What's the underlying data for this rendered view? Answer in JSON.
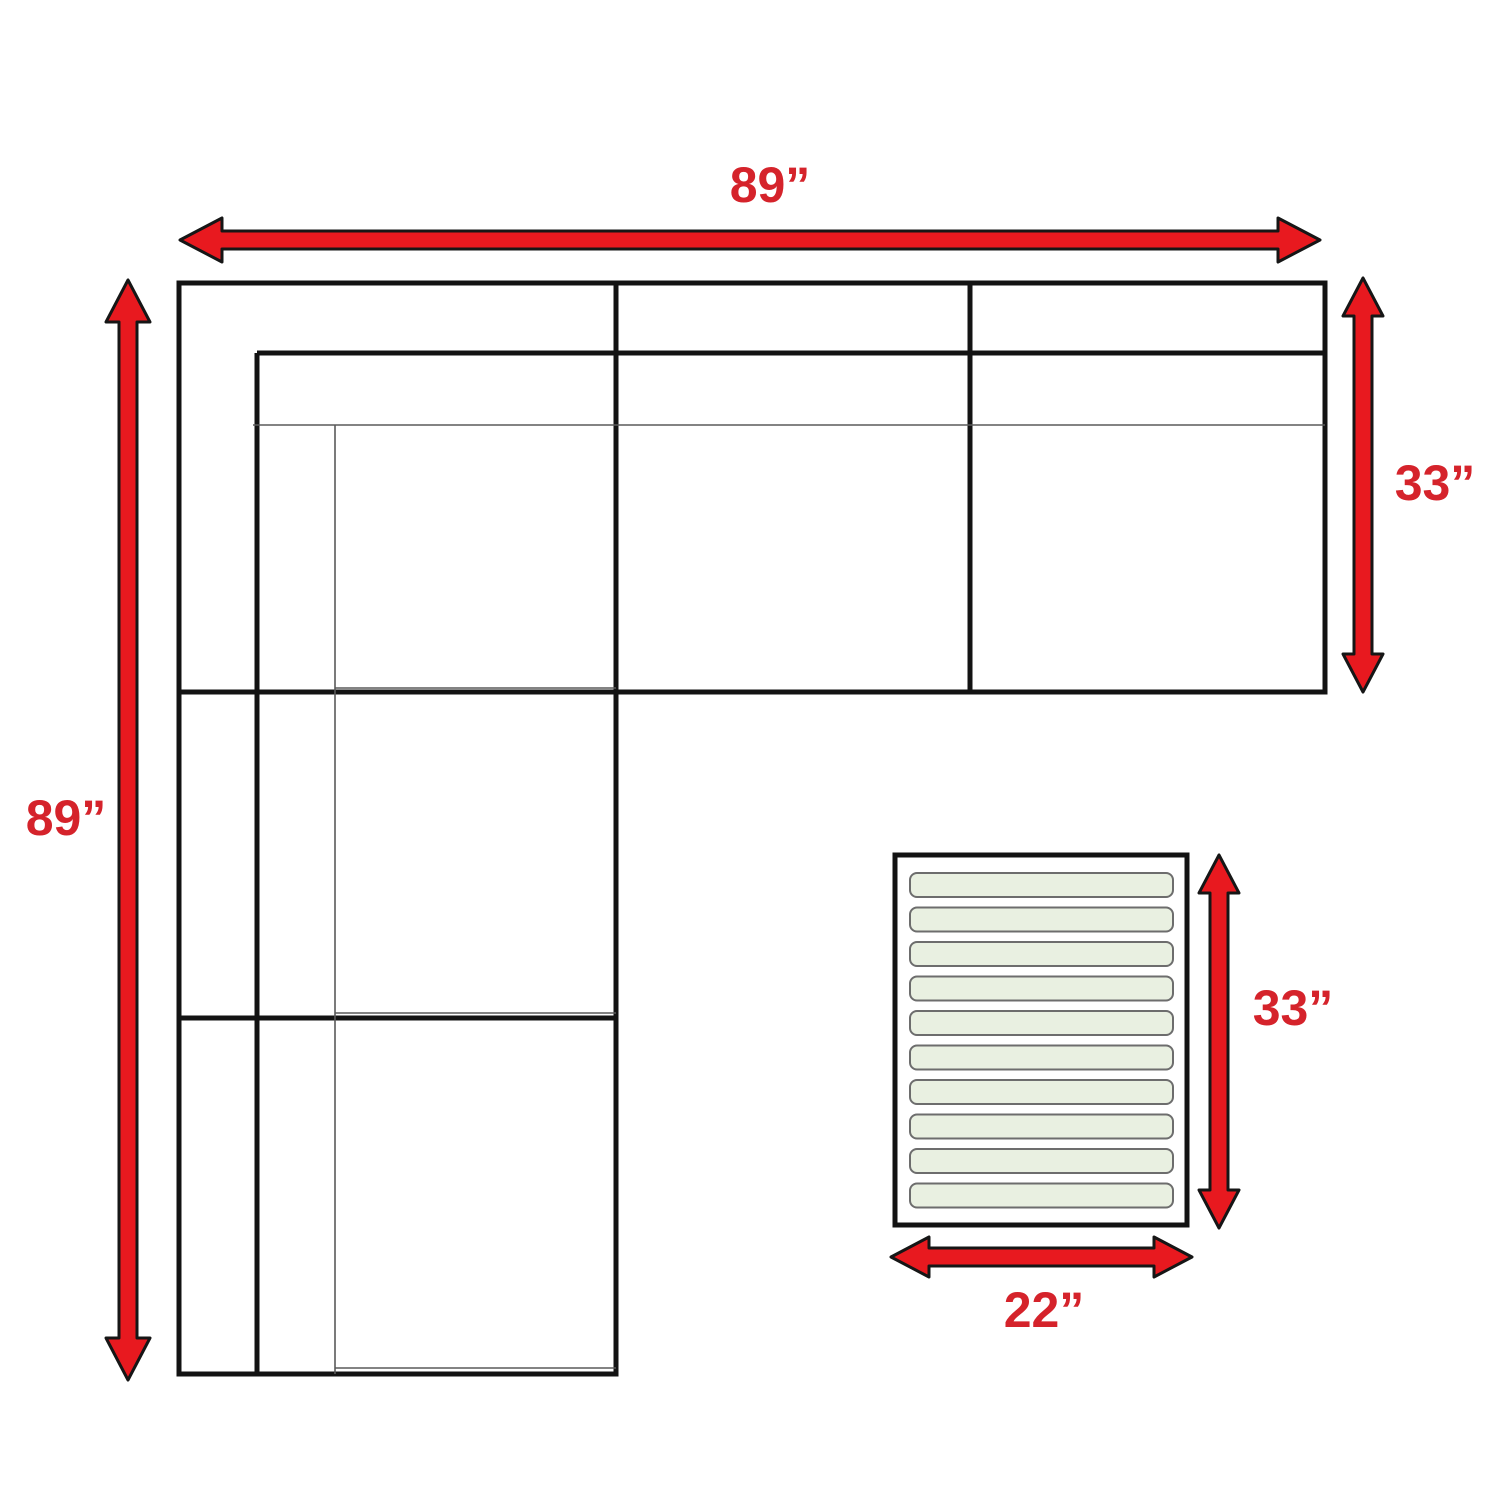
{
  "diagram": {
    "type": "furniture-dimension-diagram",
    "subject": "L-shaped sectional sofa top view with slatted ottoman"
  },
  "labels": {
    "sofa_width": "89”",
    "sofa_depth": "89”",
    "section_depth": "33”",
    "ottoman_depth": "33”",
    "ottoman_width": "22”"
  },
  "ottoman": {
    "slat_count": 10
  },
  "colors": {
    "background": "#ffffff",
    "line_black": "#131313",
    "thin_line": "#5a5a5a",
    "arrow_fill": "#e8191f",
    "arrow_outline": "#161616",
    "label_red": "#d5232b",
    "slat_fill": "#e9f0e1",
    "slat_border": "#6d6d6d"
  }
}
